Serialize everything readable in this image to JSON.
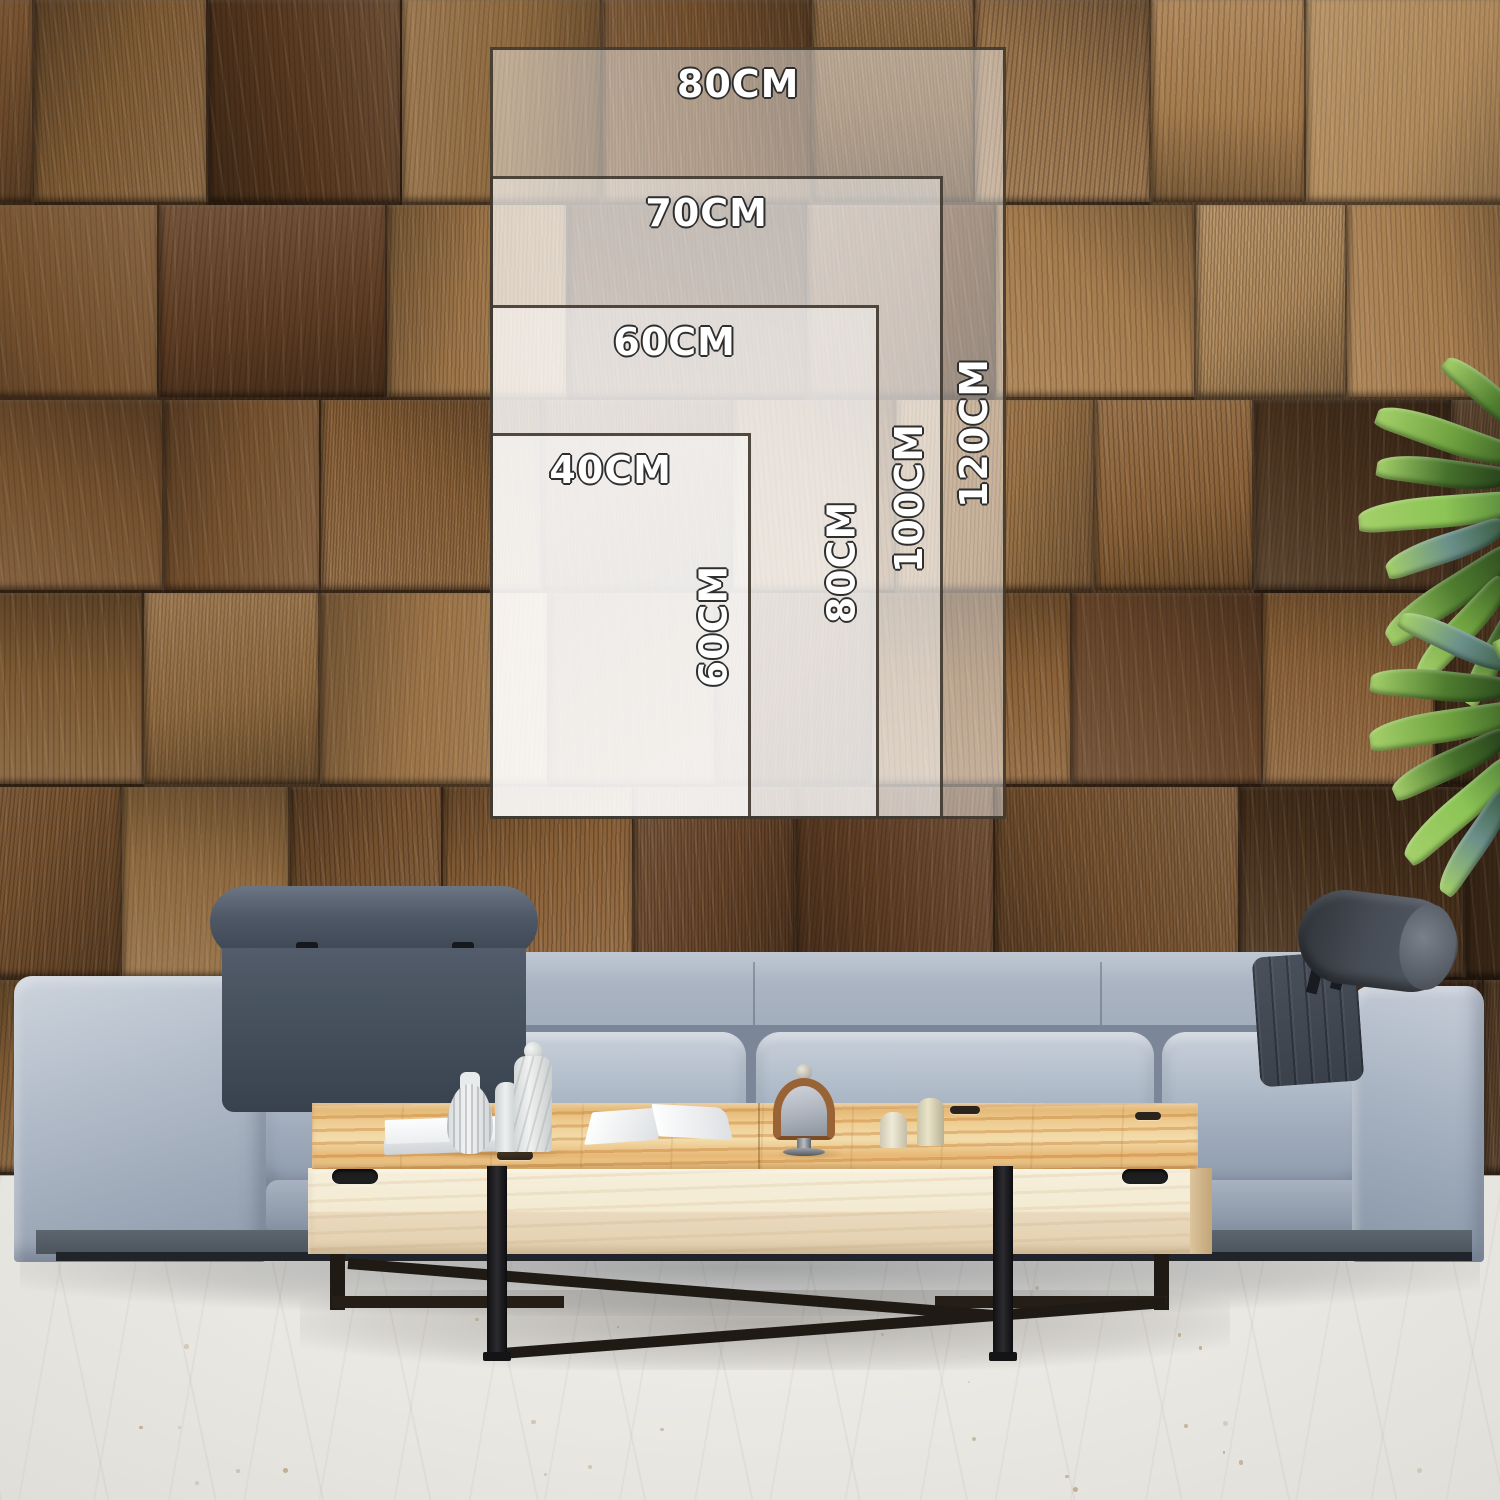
{
  "size_guide": {
    "unit": "CM",
    "sizes": [
      {
        "name": "size-80x120",
        "width_label": "80CM",
        "height_label": "120CM"
      },
      {
        "name": "size-70x100",
        "width_label": "70CM",
        "height_label": "100CM"
      },
      {
        "name": "size-60x80",
        "width_label": "60CM",
        "height_label": "80CM"
      },
      {
        "name": "size-40x60",
        "width_label": "40CM",
        "height_label": "60CM"
      }
    ]
  },
  "colors": {
    "overlay_fill": "rgba(255,255,255,0.44)",
    "overlay_border": "rgba(52,43,33,0.85)",
    "label_fill": "#ffffff",
    "label_outline": "#2e2e2e",
    "wall_wood": "#7b5634",
    "floor": "#eae8e3",
    "sofa_fabric": "#a5b0bf",
    "headrest_quilted": "#47515d",
    "headrest_roll": "#474d56",
    "table_top_wood": "#ecc98c",
    "table_front": "#f2e9d2",
    "metal_frame": "#1c1c1e",
    "plant_green": "#4e7d33",
    "decor_white": "#f0f1f1"
  }
}
